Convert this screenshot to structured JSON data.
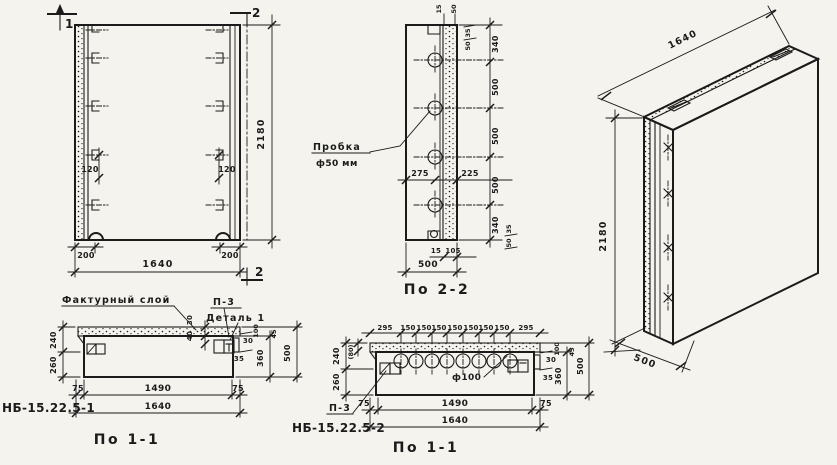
{
  "drawing": {
    "background": "#f4f3ee",
    "ink": "#1b1b1b",
    "type": "concrete wall panel working drawing"
  },
  "front_view": {
    "section_cut_top_left": "1",
    "section_cut_top_right": "2",
    "section_cut_bottom_right": "2",
    "dim_height": "2180",
    "dim_width": "1640",
    "dim_edge_left": "200",
    "dim_edge_right": "200",
    "dim_anchor_left": "120",
    "dim_anchor_right": "120"
  },
  "section_2_2": {
    "caption": "По 2-2",
    "plug_label": "Пробка",
    "plug_size": "ф50 мм",
    "plug_count": 4,
    "dim_segments": [
      "340",
      "500",
      "500",
      "500",
      "340"
    ],
    "dim_top_a": "15",
    "dim_top_b": "50",
    "dim_top_side_a": "35",
    "dim_top_side_b": "50",
    "dim_bottom_side_a": "35",
    "dim_bottom_side_b": "50",
    "dim_left_of_axis": "275",
    "dim_right_of_axis": "225",
    "dim_bottom_a": "15",
    "dim_bottom_b": "105",
    "dim_depth": "500"
  },
  "iso_view": {
    "dim_width": "1640",
    "dim_height": "2180",
    "dim_depth": "500"
  },
  "section_1_1_left": {
    "caption": "По 1-1",
    "mark": "НБ-15.22.5-1",
    "facing_layer_label": "Фактурный слой",
    "detail_ref": "П-3",
    "detail_label": "Деталь 1",
    "dim_240": "240",
    "dim_260": "260",
    "dim_30_layer": "30",
    "dim_40": "40",
    "dim_30_right": "30",
    "dim_35": "35",
    "dim_100": "100",
    "dim_45": "45",
    "dim_360": "360",
    "dim_500": "500",
    "dim_75_left": "75",
    "dim_1490": "1490",
    "dim_75_right": "75",
    "dim_1640": "1640"
  },
  "section_1_1_mid": {
    "caption": "По 1-1",
    "mark": "НБ-15.22.5-2",
    "detail_ref": "П-3",
    "hole_label": "ф100",
    "hole_count": 8,
    "top_dims": [
      "295",
      "150",
      "150",
      "150",
      "150",
      "150",
      "150",
      "150",
      "295"
    ],
    "dim_240": "240",
    "dim_80": "(80)",
    "dim_260": "260",
    "dim_30": "30",
    "dim_35": "35",
    "dim_100": "100",
    "dim_45": "45",
    "dim_360": "360",
    "dim_500": "500",
    "dim_75_left": "75",
    "dim_1490": "1490",
    "dim_75_right": "75",
    "dim_1640": "1640"
  }
}
